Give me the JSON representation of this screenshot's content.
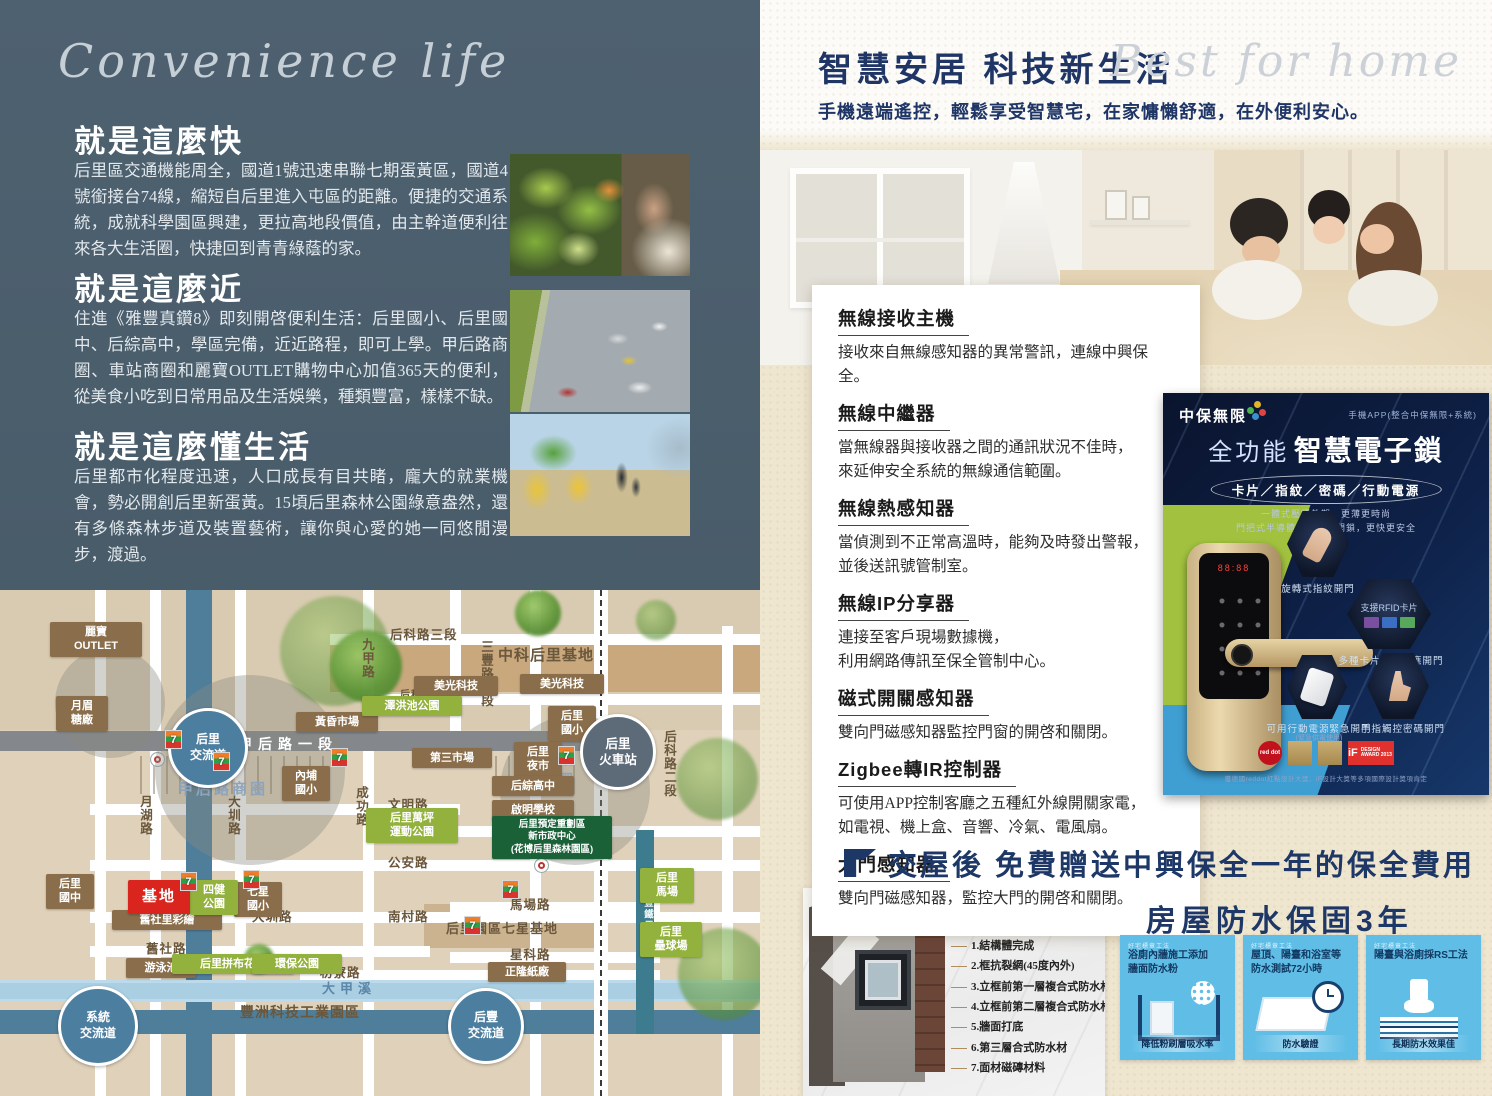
{
  "left": {
    "script_title": "Convenience life",
    "sections": [
      {
        "heading": "就是這麼快",
        "body": "后里區交通機能周全，國道1號迅速串聯七期蛋黃區，國道4號銜接台74線，縮短自后里進入屯區的距離。便捷的交通系統，成就科學園區興建，更拉高地段價值，由主幹道便利往來各大生活圈，快捷回到青青綠蔭的家。"
      },
      {
        "heading": "就是這麼近",
        "body": "住進《雅豐真鑽8》即刻開啓便利生活：后里國小、后里國中、后綜高中，學區完備，近近路程，即可上學。甲后路商圈、車站商圈和麗寶OUTLET購物中心加值365天的便利，從美食小吃到日常用品及生活娛樂，種類豐富，樣樣不缺。"
      },
      {
        "heading": "就是這麼懂生活",
        "body": "后里都市化程度迅速，人口成長有目共睹，龐大的就業機會，勢必開創后里新蛋黃。15頃后里森林公園綠意盎然，還有多條森林步道及裝置藝術，讓你與心愛的她一同悠閒漫步，渡過。"
      }
    ]
  },
  "map": {
    "items": [
      {
        "k": "zc",
        "x": 155,
        "y": 85,
        "s": 190
      },
      {
        "k": "zc",
        "x": 500,
        "y": 125,
        "s": 150
      },
      {
        "k": "zc",
        "x": 55,
        "y": 58,
        "s": 110
      },
      {
        "k": "tree",
        "x": 280,
        "y": 6,
        "s": 110,
        "o": 0.5
      },
      {
        "k": "tree",
        "x": 330,
        "y": 40,
        "s": 72,
        "o": 0.95
      },
      {
        "k": "tree",
        "x": 515,
        "y": 0,
        "s": 46,
        "o": 0.95
      },
      {
        "k": "tree",
        "x": 636,
        "y": 10,
        "s": 40,
        "o": 0.6
      },
      {
        "k": "tree",
        "x": 676,
        "y": 148,
        "s": 82,
        "o": 0.55
      },
      {
        "k": "tree",
        "x": 678,
        "y": 338,
        "s": 92,
        "o": 0.6
      },
      {
        "k": "tree",
        "x": 244,
        "y": 354,
        "s": 30,
        "o": 0.95
      },
      {
        "k": "r",
        "t": "后科路三段",
        "x": 390,
        "y": 34
      },
      {
        "k": "r",
        "t": "中科后里基地",
        "x": 498,
        "y": 54,
        "fs": 15
      },
      {
        "k": "r",
        "t": "后科南路",
        "x": 400,
        "y": 96,
        "fs": 10
      },
      {
        "k": "r",
        "t": "九甲路",
        "x": 358,
        "y": 48,
        "v": true
      },
      {
        "k": "r",
        "t": "三豐路三段",
        "x": 477,
        "y": 50,
        "v": true
      },
      {
        "k": "r",
        "t": "后科路二段",
        "x": 660,
        "y": 140,
        "v": true
      },
      {
        "k": "r",
        "t": "月湖路",
        "x": 136,
        "y": 205,
        "v": true
      },
      {
        "k": "r",
        "t": "大圳路",
        "x": 224,
        "y": 205,
        "v": true
      },
      {
        "k": "r",
        "t": "成功路",
        "x": 352,
        "y": 196,
        "v": true
      },
      {
        "k": "hw",
        "t": "甲后路一段",
        "x": 238,
        "y": 144
      },
      {
        "k": "zone",
        "t": "甲后路商圈",
        "x": 178,
        "y": 188
      },
      {
        "k": "zone",
        "t": "車站\n商圈",
        "x": 540,
        "y": 158
      },
      {
        "k": "r",
        "t": "文明路",
        "x": 388,
        "y": 204
      },
      {
        "k": "r",
        "t": "大山路",
        "x": 520,
        "y": 226
      },
      {
        "k": "r",
        "t": "公安路",
        "x": 388,
        "y": 262
      },
      {
        "k": "r",
        "t": "大圳路",
        "x": 252,
        "y": 316
      },
      {
        "k": "r",
        "t": "南村路",
        "x": 388,
        "y": 316
      },
      {
        "k": "r",
        "t": "舊社路",
        "x": 146,
        "y": 348
      },
      {
        "k": "r",
        "t": "枋寮路",
        "x": 320,
        "y": 372
      },
      {
        "k": "r",
        "t": "馬場路",
        "x": 510,
        "y": 304
      },
      {
        "k": "r",
        "t": "星科路",
        "x": 510,
        "y": 354
      },
      {
        "k": "rv",
        "t": "大甲溪",
        "x": 322,
        "y": 388
      },
      {
        "k": "r",
        "t": "豐洲科技工業園區",
        "x": 240,
        "y": 412,
        "fs": 14
      },
      {
        "k": "bike",
        "t": "后豐鐵馬道",
        "x": 640,
        "y": 296,
        "v": true
      },
      {
        "k": "r",
        "t": "后里園區七星基地",
        "x": 446,
        "y": 328,
        "fs": 13
      },
      {
        "k": "b",
        "t": "麗寶\nOUTLET",
        "x": 50,
        "y": 32,
        "w": 84
      },
      {
        "k": "b",
        "t": "月眉\n糖廠",
        "x": 56,
        "y": 106,
        "w": 44
      },
      {
        "k": "b",
        "t": "黃昏市場",
        "x": 296,
        "y": 122,
        "w": 74
      },
      {
        "k": "b",
        "t": "內埔\n國小",
        "x": 282,
        "y": 176,
        "w": 40
      },
      {
        "k": "b",
        "t": "美光科技",
        "x": 414,
        "y": 86,
        "w": 76
      },
      {
        "k": "b",
        "t": "美光科技",
        "x": 520,
        "y": 84,
        "w": 76
      },
      {
        "k": "b",
        "t": "后里\n國小",
        "x": 548,
        "y": 116,
        "w": 40
      },
      {
        "k": "b",
        "t": "第三市場",
        "x": 412,
        "y": 158,
        "w": 72
      },
      {
        "k": "b",
        "t": "后里\n夜市",
        "x": 514,
        "y": 152,
        "w": 40
      },
      {
        "k": "b",
        "t": "后綜高中",
        "x": 492,
        "y": 186,
        "w": 74
      },
      {
        "k": "b",
        "t": "啟明學校",
        "x": 492,
        "y": 210,
        "w": 74
      },
      {
        "k": "b",
        "t": "后里\n國中",
        "x": 46,
        "y": 284,
        "w": 40
      },
      {
        "k": "b",
        "t": "舊社里彩繪",
        "x": 112,
        "y": 320,
        "w": 102
      },
      {
        "k": "b",
        "t": "七星\n國小",
        "x": 234,
        "y": 292,
        "w": 40
      },
      {
        "k": "b",
        "t": "游泳池",
        "x": 126,
        "y": 368,
        "w": 62
      },
      {
        "k": "b",
        "t": "正隆紙廠",
        "x": 488,
        "y": 372,
        "w": 70
      },
      {
        "k": "g",
        "t": "澤洪池公園",
        "x": 362,
        "y": 106,
        "w": 92
      },
      {
        "k": "g",
        "t": "后里萬坪\n運動公園",
        "x": 366,
        "y": 218,
        "w": 84
      },
      {
        "k": "g",
        "t": "四健\n公園",
        "x": 190,
        "y": 290,
        "w": 40
      },
      {
        "k": "g",
        "t": "后里拼布花園",
        "x": 172,
        "y": 364,
        "w": 114
      },
      {
        "k": "g",
        "t": "環保公園",
        "x": 252,
        "y": 364,
        "w": 82
      },
      {
        "k": "g",
        "t": "后里\n馬場",
        "x": 640,
        "y": 278,
        "w": 46
      },
      {
        "k": "g",
        "t": "后里\n壘球場",
        "x": 640,
        "y": 332,
        "w": 54
      },
      {
        "k": "dg",
        "t": "后里預定重劃區\n新市政中心\n(花博后里森林園區)",
        "x": 492,
        "y": 226,
        "w": 112
      },
      {
        "k": "red",
        "t": "基地",
        "x": 128,
        "y": 290,
        "w": 54
      },
      {
        "k": "ic",
        "t": "后里\n交流道",
        "x": 168,
        "y": 118,
        "s": 74
      },
      {
        "k": "ic",
        "t": "系統\n交流道",
        "x": 58,
        "y": 396,
        "s": 74
      },
      {
        "k": "ic",
        "t": "后豐\n交流道",
        "x": 448,
        "y": 398,
        "s": 70
      },
      {
        "k": "st",
        "t": "后里\n火車站",
        "x": 580,
        "y": 124,
        "s": 70
      },
      {
        "k": "seven",
        "x": 165,
        "y": 140
      },
      {
        "k": "seven",
        "x": 213,
        "y": 162
      },
      {
        "k": "seven",
        "x": 331,
        "y": 158
      },
      {
        "k": "seven",
        "x": 558,
        "y": 156
      },
      {
        "k": "seven",
        "x": 180,
        "y": 282
      },
      {
        "k": "seven",
        "x": 243,
        "y": 280
      },
      {
        "k": "seven",
        "x": 502,
        "y": 290
      },
      {
        "k": "seven",
        "x": 464,
        "y": 326
      }
    ]
  },
  "right": {
    "title": "智慧安居 科技新生活",
    "script_title": "Best for home",
    "subtitle": "手機遠端遙控，輕鬆享受智慧宅，在家慵懶舒適，在外便利安心。",
    "features": [
      {
        "title": "無線接收主機",
        "l1": "接收來自無線感知器的異常警訊，連線中興保全。",
        "l2": ""
      },
      {
        "title": "無線中繼器",
        "l1": "當無線器與接收器之間的通訊狀況不佳時，",
        "l2": "來延伸安全系統的無線通信範圍。"
      },
      {
        "title": "無線熱感知器",
        "l1": "當偵測到不正常高溫時，能夠及時發出警報，",
        "l2": "並後送訊號管制室。"
      },
      {
        "title": "無線IP分享器",
        "l1": "連接至客戶現場數據機，",
        "l2": "利用網路傳訊至保全管制中心。"
      },
      {
        "title": "磁式開關感知器",
        "l1": "雙向門磁感知器監控門窗的開啓和關閉。",
        "l2": ""
      },
      {
        "title": "Zigbee轉IR控制器",
        "l1": "可使用APP控制客廳之五種紅外線開關家電，",
        "l2": "如電視、機上盒、音響、冷氣、電風扇。"
      },
      {
        "title": "大門感知器",
        "l1": "雙向門磁感知器，監控大門的開啓和關閉。",
        "l2": ""
      }
    ],
    "product": {
      "brand": "中保無限",
      "app_note": "手機APP(整合中保無限+系統)",
      "title_light": "全功能",
      "title_bold": "智慧電子鎖",
      "methods": "卡片／指紋／密碼／行動電源",
      "sub1": "一體式壓鑄外觀，更薄更時尚",
      "sub2": "門把式半導體電容指紋開鎖，更快更安全",
      "display": "88:88",
      "hex1_label": "旋轉式指紋開門",
      "hex2_title": "支援RFID卡片",
      "hex2_label": "多種卡片皆可感應開門",
      "hex3_label": "可用行動電源緊急開門",
      "hex3_sub": "(緊急供電使用)",
      "hex4_label": "手指觸控密碼開門",
      "award_reddot": "red dot",
      "award_if": "iF",
      "award_if_sub": "DESIGN AWARD 2013",
      "disclaimer": "獲德國reddot紅點設計大獎、iF設計大獎等多項國際設計獎項肯定"
    },
    "banner": "交屋後  免費贈送中興保全一年的保全費用",
    "warranty": "房屋防水保固3年",
    "window": {
      "label": "窗框三道防水",
      "steps": [
        "1.結構體完成",
        "2.框抗裂網(45度內外)",
        "3.立框前第一層複合式防水材",
        "4.立框前第二層複合式防水材",
        "5.牆面打底",
        "6.第三層合式防水材",
        "7.面材磁磚材料"
      ]
    },
    "cards": [
      {
        "head": "好宅標章工法",
        "title": "浴廁內牆施工添加\n牆面防水粉",
        "badge": "降低粉刷層吸水率"
      },
      {
        "head": "好宅標章工法",
        "title": "屋頂、陽臺和浴室等\n防水測試72小時",
        "badge": "防水驗證"
      },
      {
        "head": "好宅標章工法",
        "title": "陽臺與浴廁採RS工法",
        "badge": "長期防水效果佳"
      }
    ]
  }
}
